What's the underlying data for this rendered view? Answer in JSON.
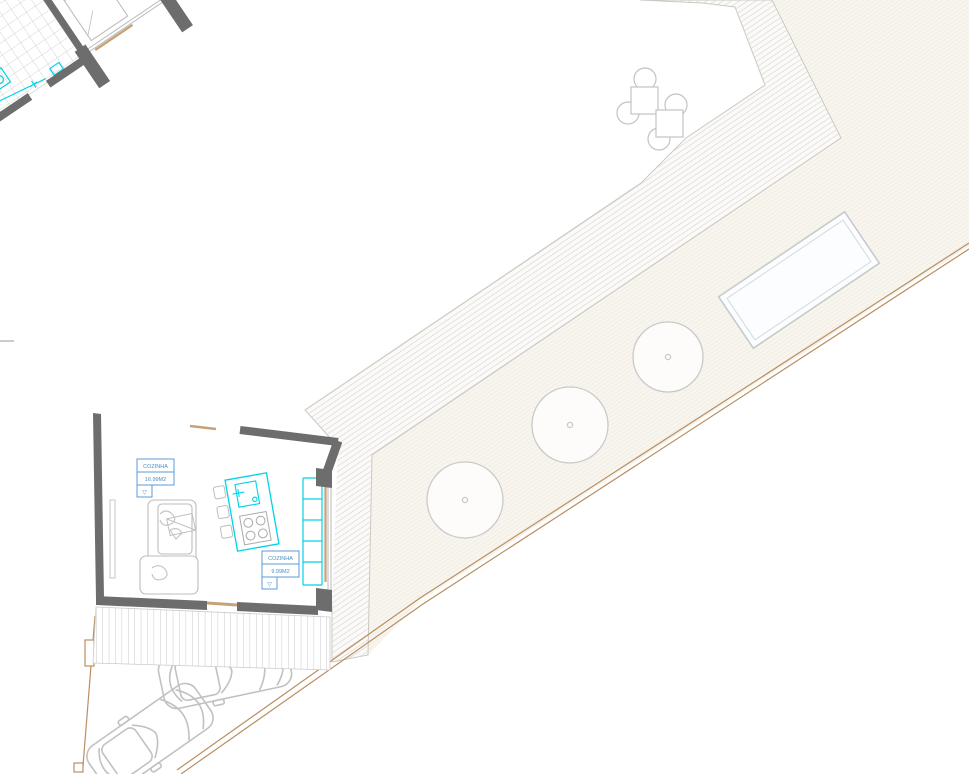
{
  "room_labels": {
    "label_left": {
      "name": "COZINHA",
      "area": "16.99M2",
      "symbol": "▽"
    },
    "label_right": {
      "name": "COZINHA",
      "area": "9.99M2",
      "symbol": "▽"
    }
  },
  "colors": {
    "wall": "#6d6d6d",
    "fixture_cyan": "#00d2e6",
    "label_blue": "#5b9bd5",
    "boundary_tan": "#b98f63",
    "sill_tan": "#c8a178",
    "furniture_gray": "#bdbdbd",
    "deck_stripe": "#cfccc5",
    "garden_fill": "#f8f5ef",
    "tile_grid": "#c8c8c8"
  }
}
